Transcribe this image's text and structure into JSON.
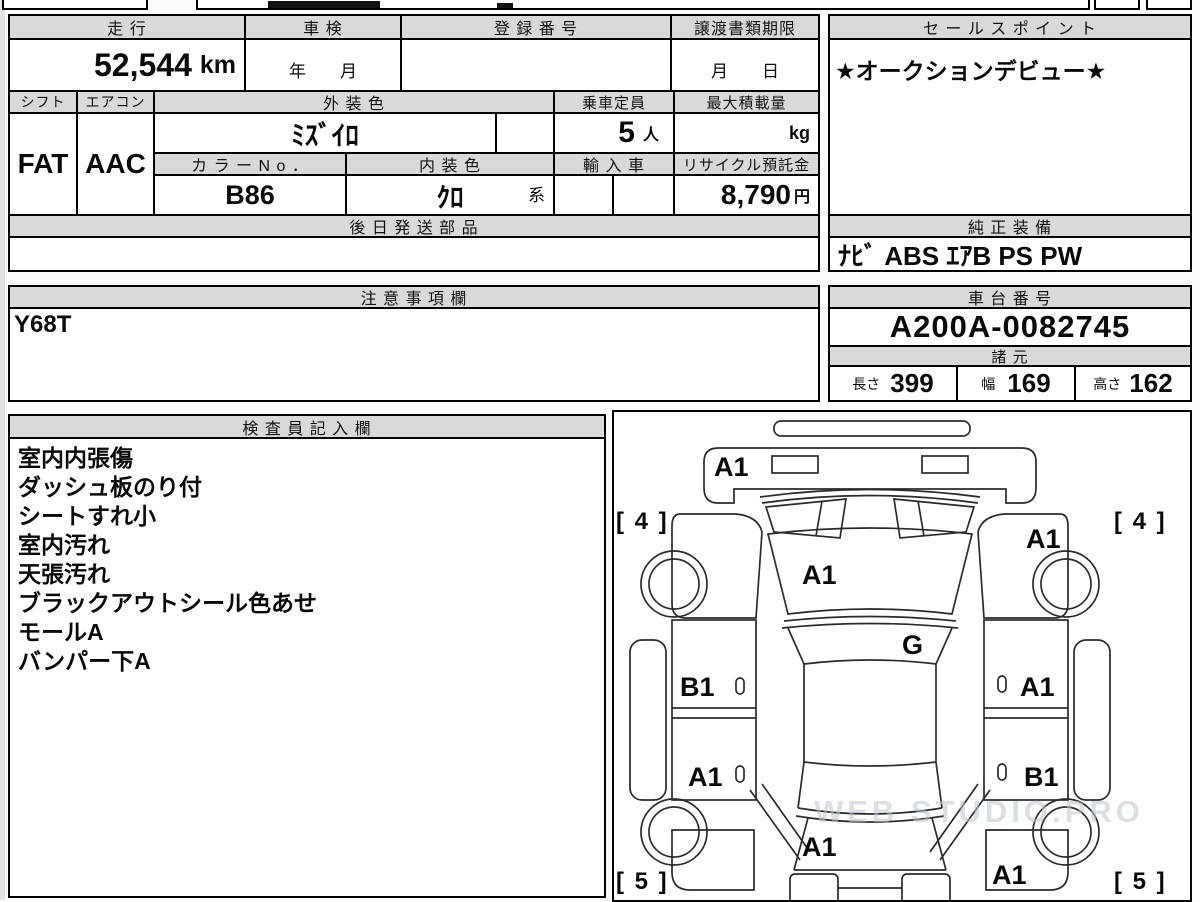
{
  "sheet": {
    "top_row": {
      "mileage_header": "走 行",
      "mileage_value": "52,544",
      "mileage_unit": "km",
      "shaken_header": "車 検",
      "shaken_value": "年　　月",
      "registration_header": "登 録 番 号",
      "deadline_header": "譲渡書類期限",
      "deadline_value": "月　　日"
    },
    "vehicle": {
      "shift_header": "シフト",
      "shift_value": "FAT",
      "aircon_header": "エアコン",
      "aircon_value": "AAC",
      "exterior_color_header": "外 装 色",
      "exterior_color_value": "ﾐｽﾞｲﾛ",
      "capacity_header": "乗車定員",
      "capacity_value": "5",
      "capacity_unit": "人",
      "payload_header": "最大積載量",
      "payload_unit": "kg",
      "color_no_header": "カ ラ ー N o ．",
      "color_no_value": "B86",
      "interior_color_header": "内 装 色",
      "interior_color_value": "ｸﾛ",
      "interior_color_suffix": "系",
      "import_header": "輸 入 車",
      "recycle_header": "リサイクル預託金",
      "recycle_value": "8,790",
      "recycle_unit": "円"
    },
    "parts_header": "後 日 発 送 部 品",
    "sales": {
      "header": "セ ー ル ス ポ イ ン ト",
      "value": "★オークションデビュー★"
    },
    "equipment": {
      "header": "純 正 装 備",
      "value": "ﾅﾋﾞ ABS ｴｱB PS PW"
    },
    "notes": {
      "header": "注 意 事 項 欄",
      "value": "Y68T"
    },
    "chassis": {
      "header": "車 台 番 号",
      "value": "A200A-0082745"
    },
    "specs": {
      "header": "諸 元",
      "length_label": "長さ",
      "length_value": "399",
      "width_label": "幅",
      "width_value": "169",
      "height_label": "高さ",
      "height_value": "162"
    },
    "inspector": {
      "header": "検 査 員 記 入 欄",
      "lines": [
        "室内内張傷",
        "ダッシュ板のり付",
        "シートすれ小",
        "室内汚れ",
        "天張汚れ",
        "ブラックアウトシール色あせ",
        "モールA",
        "バンパー下A"
      ]
    },
    "diagram": {
      "labels": [
        {
          "id": "front-bumper",
          "text": "A1"
        },
        {
          "id": "front-tire-left",
          "text": "[ 4 ]"
        },
        {
          "id": "front-tire-right",
          "text": "[ 4 ]"
        },
        {
          "id": "front-fender-right",
          "text": "A1"
        },
        {
          "id": "hood",
          "text": "A1"
        },
        {
          "id": "roof",
          "text": "G"
        },
        {
          "id": "door-front-left",
          "text": "B1"
        },
        {
          "id": "door-front-right",
          "text": "A1"
        },
        {
          "id": "door-rear-left",
          "text": "A1"
        },
        {
          "id": "door-rear-right",
          "text": "B1"
        },
        {
          "id": "rear-gate",
          "text": "A1"
        },
        {
          "id": "rear-bumper-right",
          "text": "A1"
        },
        {
          "id": "rear-tire-left",
          "text": "[ 5 ]"
        },
        {
          "id": "rear-tire-right",
          "text": "[ 5 ]"
        }
      ],
      "watermark": "WEB STUDIO.PRO"
    }
  }
}
